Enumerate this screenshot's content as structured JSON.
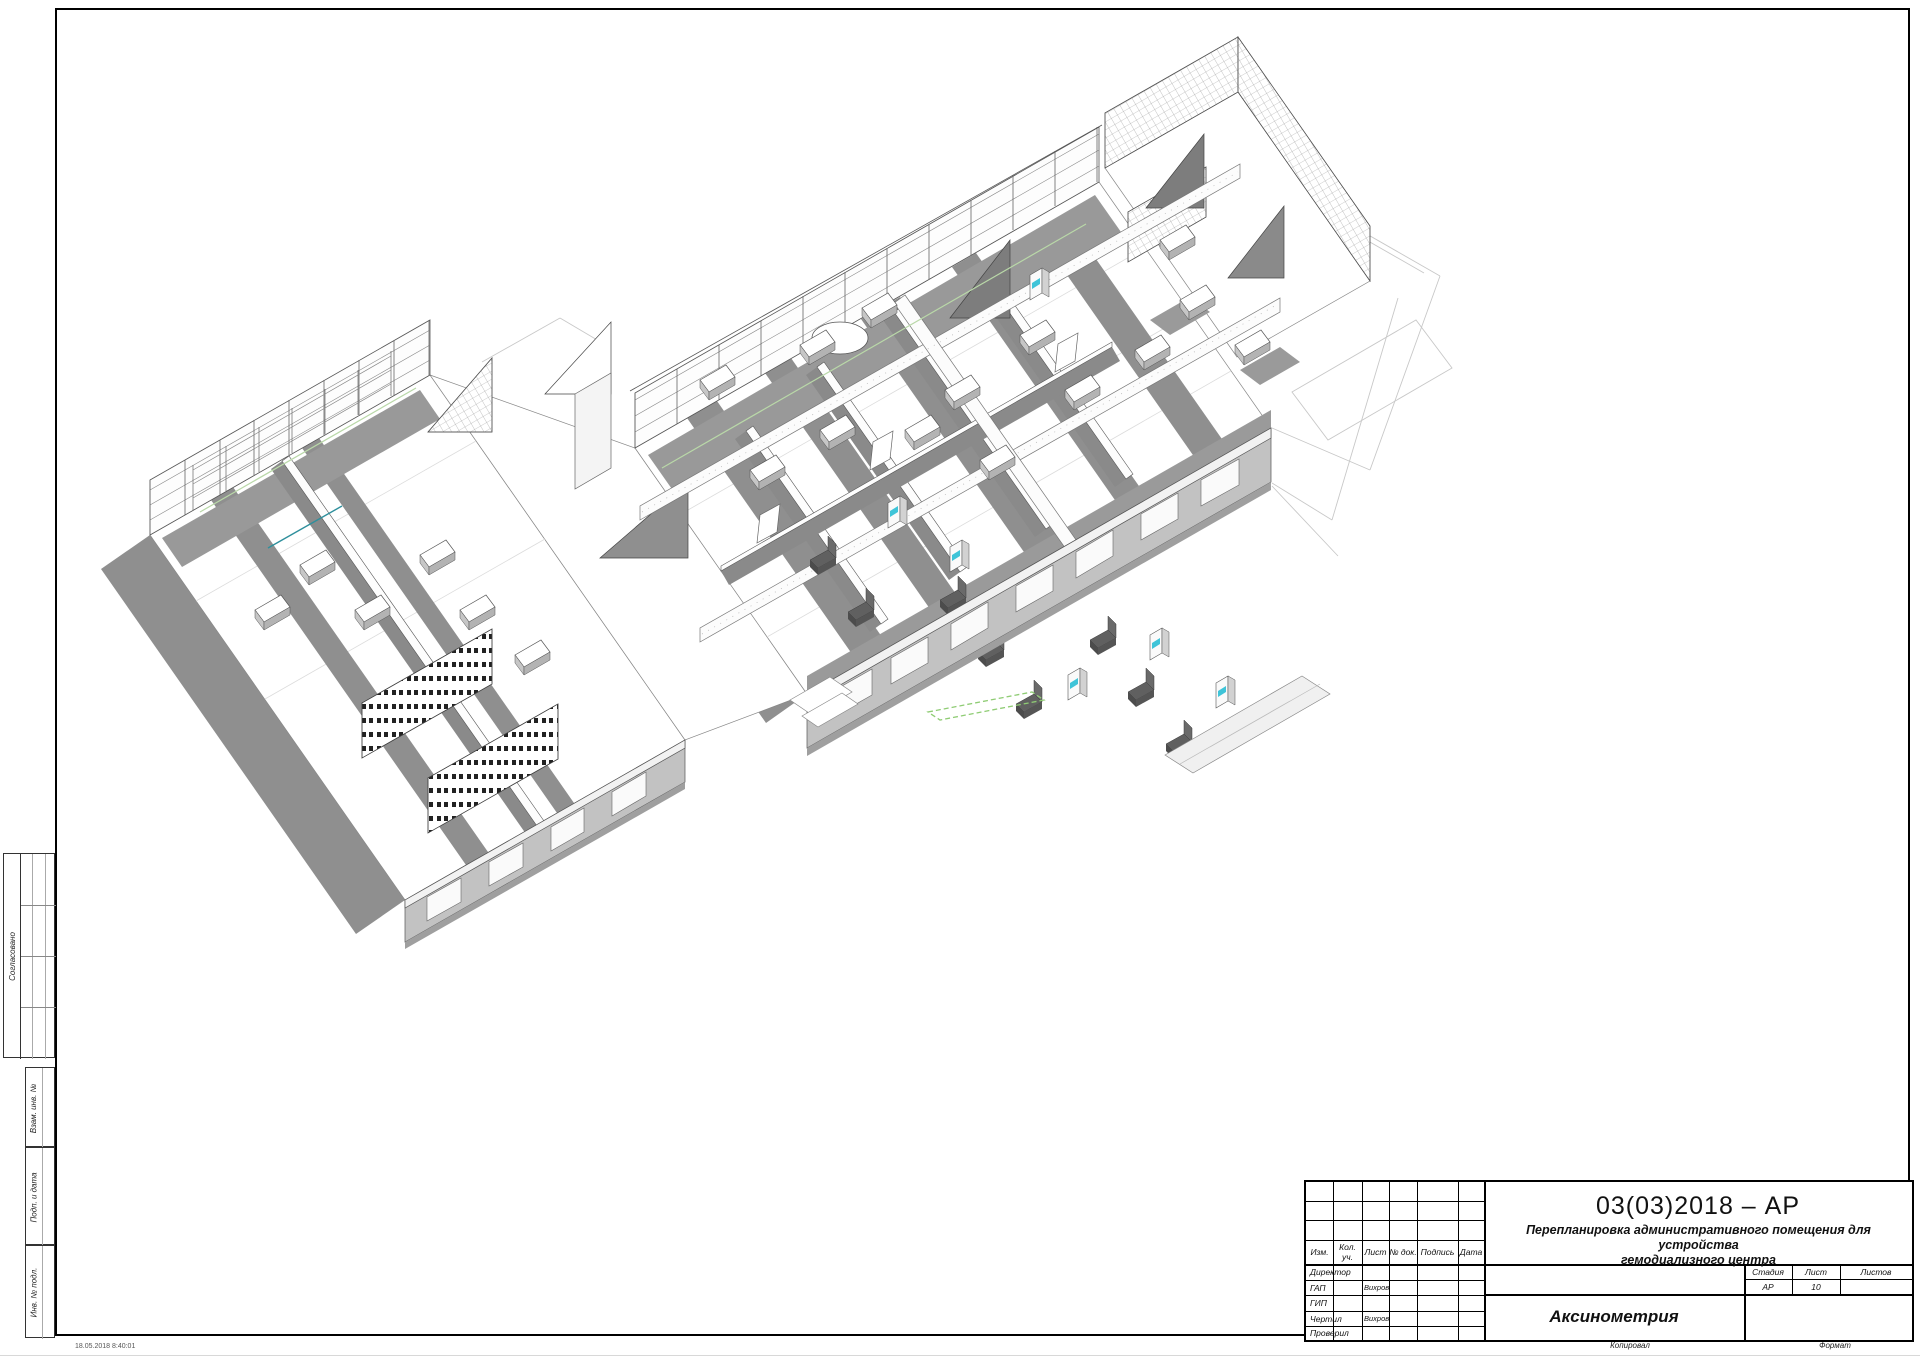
{
  "sheet": {
    "timestamp": "18.05.2018 8:40:01",
    "footer_copy_label": "Копировал",
    "footer_format_label": "Формат"
  },
  "side_margin": {
    "labels": [
      "Согласовано",
      "Взам. инв. №",
      "Подп. и дата",
      "Инв. № подл."
    ]
  },
  "title_block": {
    "doc_code": "03(03)2018 – АР",
    "project_line1": "Перепланировка административного помещения для устройства",
    "project_line2": "гемодиализного центра",
    "view_name": "Аксинометрия",
    "rev_headers": [
      "Изм.",
      "Кол. уч.",
      "Лист",
      "№ док.",
      "Подпись",
      "Дата"
    ],
    "signers": [
      {
        "role": "Директор",
        "name": ""
      },
      {
        "role": "ГАП",
        "name": "Вихров"
      },
      {
        "role": "ГИП",
        "name": ""
      },
      {
        "role": "Чертил",
        "name": "Вихров"
      },
      {
        "role": "Проверил",
        "name": ""
      }
    ],
    "stage_label": "Стадия",
    "stage_value": "АР",
    "sheet_label": "Лист",
    "sheet_value": "10",
    "sheets_label": "Листов",
    "sheets_value": ""
  },
  "drawing": {
    "description": "Аксонометрический вид этажа гемодиализного центра",
    "accent_screen_color": "#3fc4d8",
    "highlight_green": "#8fcc74",
    "corridor_green": "#b9d8a8",
    "teal_line": "#2e8f9c",
    "shadow_gray": "#8f8f8f",
    "wireframe_gray": "#c8c8c8"
  }
}
